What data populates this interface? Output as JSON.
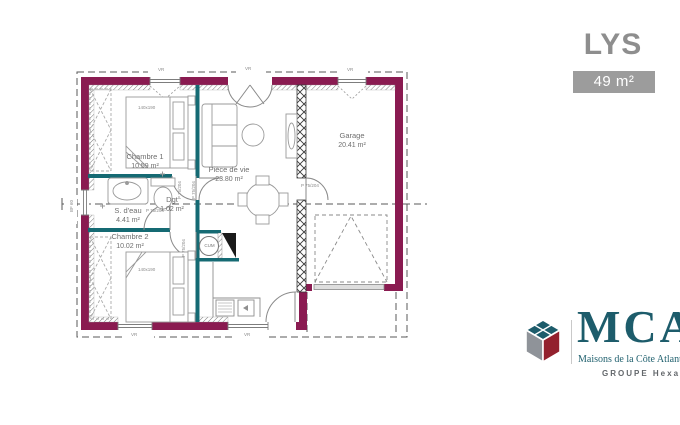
{
  "header": {
    "title": "LYS",
    "area_badge": "49 m²"
  },
  "plan": {
    "rooms": [
      {
        "id": "chambre1",
        "name": "Chambre 1",
        "area": "10.59 m²"
      },
      {
        "id": "sdeau",
        "name": "S. d'eau",
        "area": "4.41 m²"
      },
      {
        "id": "chambre2",
        "name": "Chambre 2",
        "area": "10.02 m²"
      },
      {
        "id": "dgt",
        "name": "Dgt",
        "area": "1.02 m²"
      },
      {
        "id": "piece_de_vie",
        "name": "Pièce de vie",
        "area": "23.80 m²"
      },
      {
        "id": "garage",
        "name": "Garage",
        "area": "20.41 m²"
      }
    ],
    "labels": {
      "door": "P 75/204",
      "bed": "140x190",
      "water_heater": "CUM",
      "window": "VR",
      "left_window": "BF 60"
    },
    "colors": {
      "exterior_wall": "#8a1b51",
      "partition": "#156a73",
      "label_text": "#6f6f6f"
    }
  },
  "logo": {
    "name": "MCA",
    "tagline": "Maisons de la Côte Atlantique",
    "group": "GROUPE Hexaōm"
  }
}
